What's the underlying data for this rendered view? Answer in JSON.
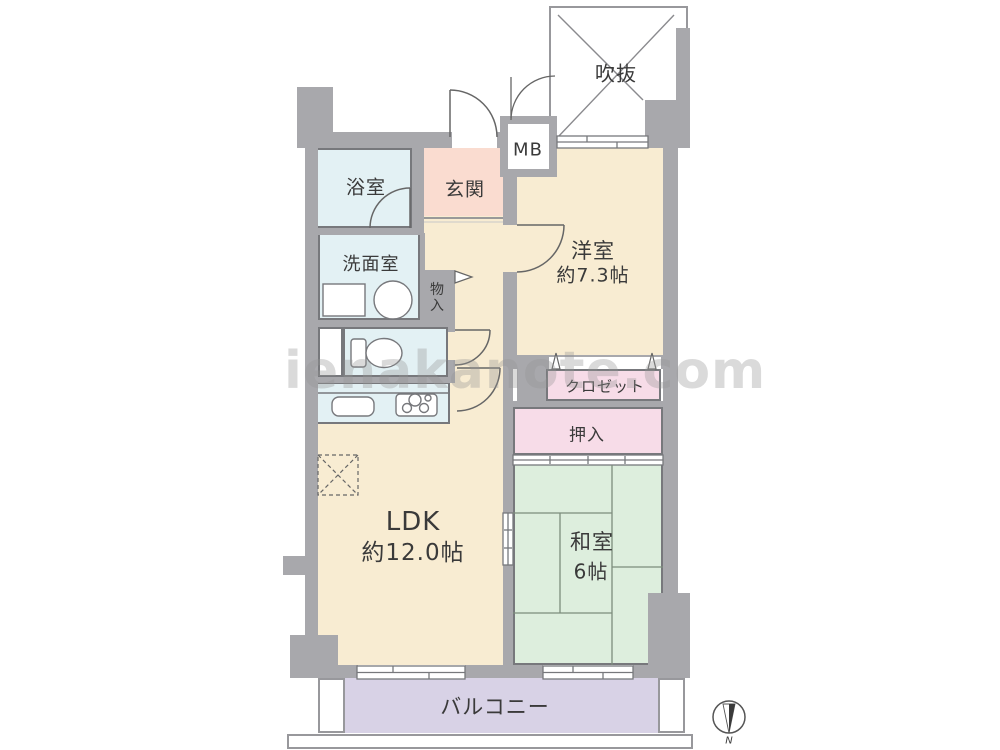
{
  "palette": {
    "wall": "#a8a8ac",
    "line": "#77787c",
    "floor-beige": "#f8ecd2",
    "entry-pink": "#fadcd0",
    "closet-pink": "#f7dce8",
    "wet-blue": "#e3f1f4",
    "tatami-green": "#ddeedd",
    "balcony-lavender": "#d8d2e6",
    "text": "#3a3a3a"
  },
  "watermark": "ienakanote.com",
  "compass": {
    "north_label": "N"
  },
  "rooms": {
    "void": {
      "label": "吹抜"
    },
    "meter_box": {
      "label": "MB"
    },
    "entry": {
      "label": "玄関"
    },
    "bath": {
      "label": "浴室"
    },
    "washroom": {
      "label": "洗面室"
    },
    "storage": {
      "label": "物入"
    },
    "western_room": {
      "label": "洋室",
      "size": "約7.3帖"
    },
    "closet": {
      "label": "クロゼット"
    },
    "futon_closet": {
      "label": "押入"
    },
    "ldk": {
      "label": "LDK",
      "size": "約12.0帖"
    },
    "japanese_room": {
      "label": "和室",
      "size": "6帖"
    },
    "balcony": {
      "label": "バルコニー"
    }
  }
}
